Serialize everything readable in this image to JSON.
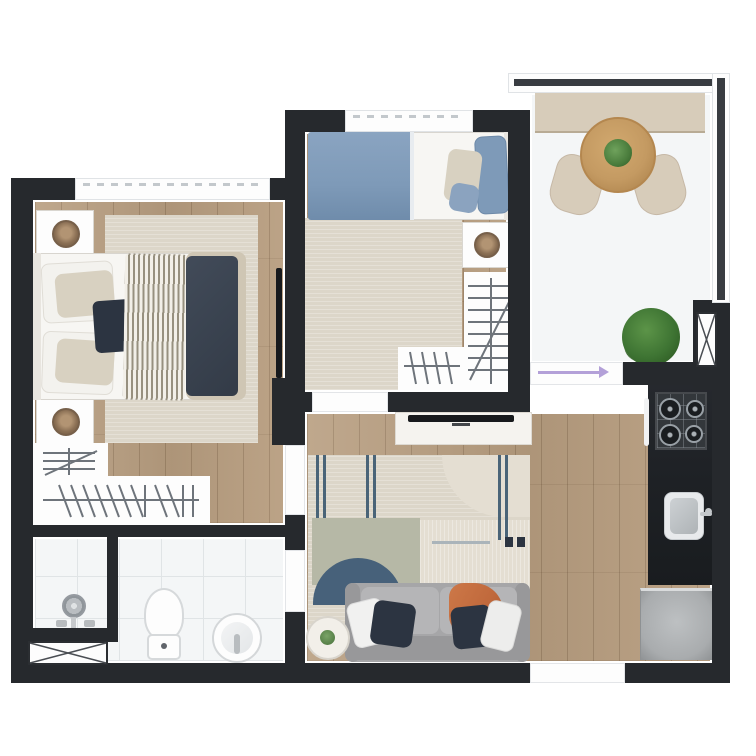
{
  "page": {
    "type": "apartment-floor-plan-3d-render",
    "visible_text": []
  },
  "colors": {
    "background": "#ffffff",
    "wall": "#26292d",
    "wall_core": "#383c41",
    "white": "#fdfdfd",
    "wood": "#b89e80",
    "tile": "#f4f6f7",
    "grout": "#e0e4e6",
    "rug_beige": "#dcd6c9",
    "rug_light": "#e4ded2",
    "rug_sage": "#b6b8a6",
    "rug_navy": "#47617a",
    "stripe_navy": "#4a6478",
    "duvet_navy": "#3a4350",
    "duvet_trim": "#cfc6b4",
    "duvet_blue": "#7e9ab8",
    "pillow_beige": "#d8d1c1",
    "pillow_navy": "#2c3441",
    "sofa": "#a6a6a8",
    "sofa_light": "#b5b5b7",
    "sofa_dark": "#98989a",
    "throw_orange": "#c0693c",
    "table_wood": "#c49a62",
    "plant_green": "#4a7c3c",
    "bush_green": "#3e7433",
    "planter": "#d7ccba",
    "counter": "#1f2226",
    "cooktop": "#33373b",
    "metal": "#c3c7ca",
    "appliance": "#a9acae",
    "sketch": "#6e747b",
    "arrow": "#b3a0d8",
    "basket": "#8a6f54",
    "stripe_throw": "#97907f"
  },
  "rooms": [
    {
      "name": "master-bedroom",
      "furniture": [
        "double-bed",
        "striped-runner",
        "navy-duvet",
        "pillows",
        "nightstand-with-basket-plant",
        "nightstand-with-basket-plant",
        "area-rug",
        "wardrobe-hanger-sketch",
        "wall-mounted-tv",
        "window"
      ]
    },
    {
      "name": "bedroom-2",
      "furniture": [
        "single-bed-blue-duvet",
        "pillows",
        "nightstand-with-basket-plant",
        "area-rug",
        "closet-hanger-sketch",
        "window",
        "door-threshold"
      ]
    },
    {
      "name": "bathroom",
      "furniture": [
        "shower-fixture",
        "shower-partition",
        "toilet",
        "round-sink",
        "utility-shaft-box",
        "door-threshold"
      ]
    },
    {
      "name": "living-room",
      "furniture": [
        "patchwork-rug",
        "half-moon-rug-accent",
        "gray-sofa",
        "orange-throw",
        "throw-pillows",
        "round-side-table",
        "tv-console",
        "flat-tv",
        "entry-door"
      ]
    },
    {
      "name": "kitchen",
      "furniture": [
        "dark-countertop",
        "gas-cooktop-4-burners",
        "oven-handle",
        "kitchen-sink-with-faucet",
        "refrigerator"
      ]
    },
    {
      "name": "balcony",
      "furniture": [
        "planter-bench",
        "round-dining-table",
        "table-plant",
        "chair",
        "chair",
        "potted-bush",
        "utility-shaft-box",
        "sliding-door-arrow",
        "parapet-railing",
        "tiled-floor"
      ]
    }
  ]
}
